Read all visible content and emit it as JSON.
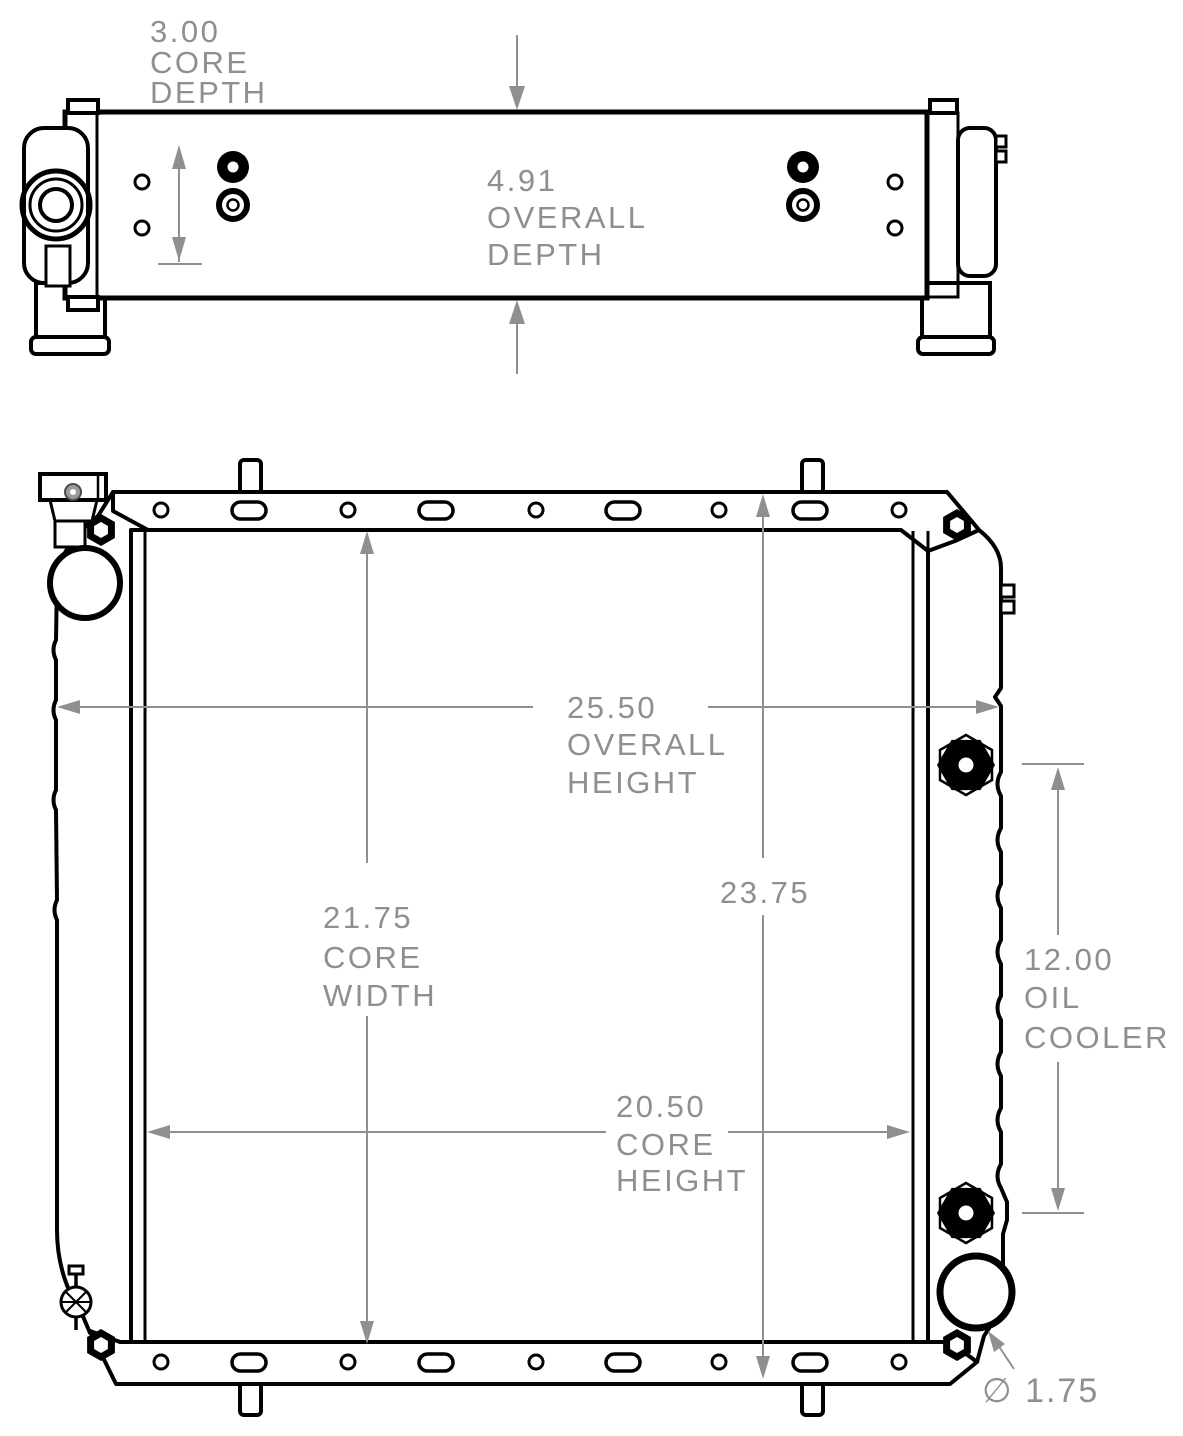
{
  "drawing": {
    "background": "#ffffff",
    "line_color": "#000000",
    "dimension_color": "#8f8f8f"
  },
  "top_view": {
    "dimensions": [
      {
        "id": "core-depth",
        "value": "3.00",
        "label_lines": [
          "3.00",
          "CORE",
          "DEPTH"
        ]
      },
      {
        "id": "overall-depth",
        "value": "4.91",
        "label_lines": [
          "4.91",
          "OVERALL",
          "DEPTH"
        ]
      }
    ]
  },
  "front_view": {
    "dimensions": [
      {
        "id": "overall-height",
        "value": "25.50",
        "label_lines": [
          "25.50",
          "OVERALL",
          "HEIGHT"
        ]
      },
      {
        "id": "core-width",
        "value": "21.75",
        "label_lines": [
          "21.75",
          "CORE",
          "WIDTH"
        ]
      },
      {
        "id": "tank-to-tank",
        "value": "23.75",
        "label_lines": [
          "23.75"
        ]
      },
      {
        "id": "core-height",
        "value": "20.50",
        "label_lines": [
          "20.50",
          "CORE",
          "HEIGHT"
        ]
      },
      {
        "id": "oil-cooler",
        "value": "12.00",
        "label_lines": [
          "12.00",
          "OIL",
          "COOLER"
        ]
      },
      {
        "id": "outlet-diameter",
        "value": "1.75",
        "label_lines": [
          "∅ 1.75"
        ]
      }
    ]
  }
}
